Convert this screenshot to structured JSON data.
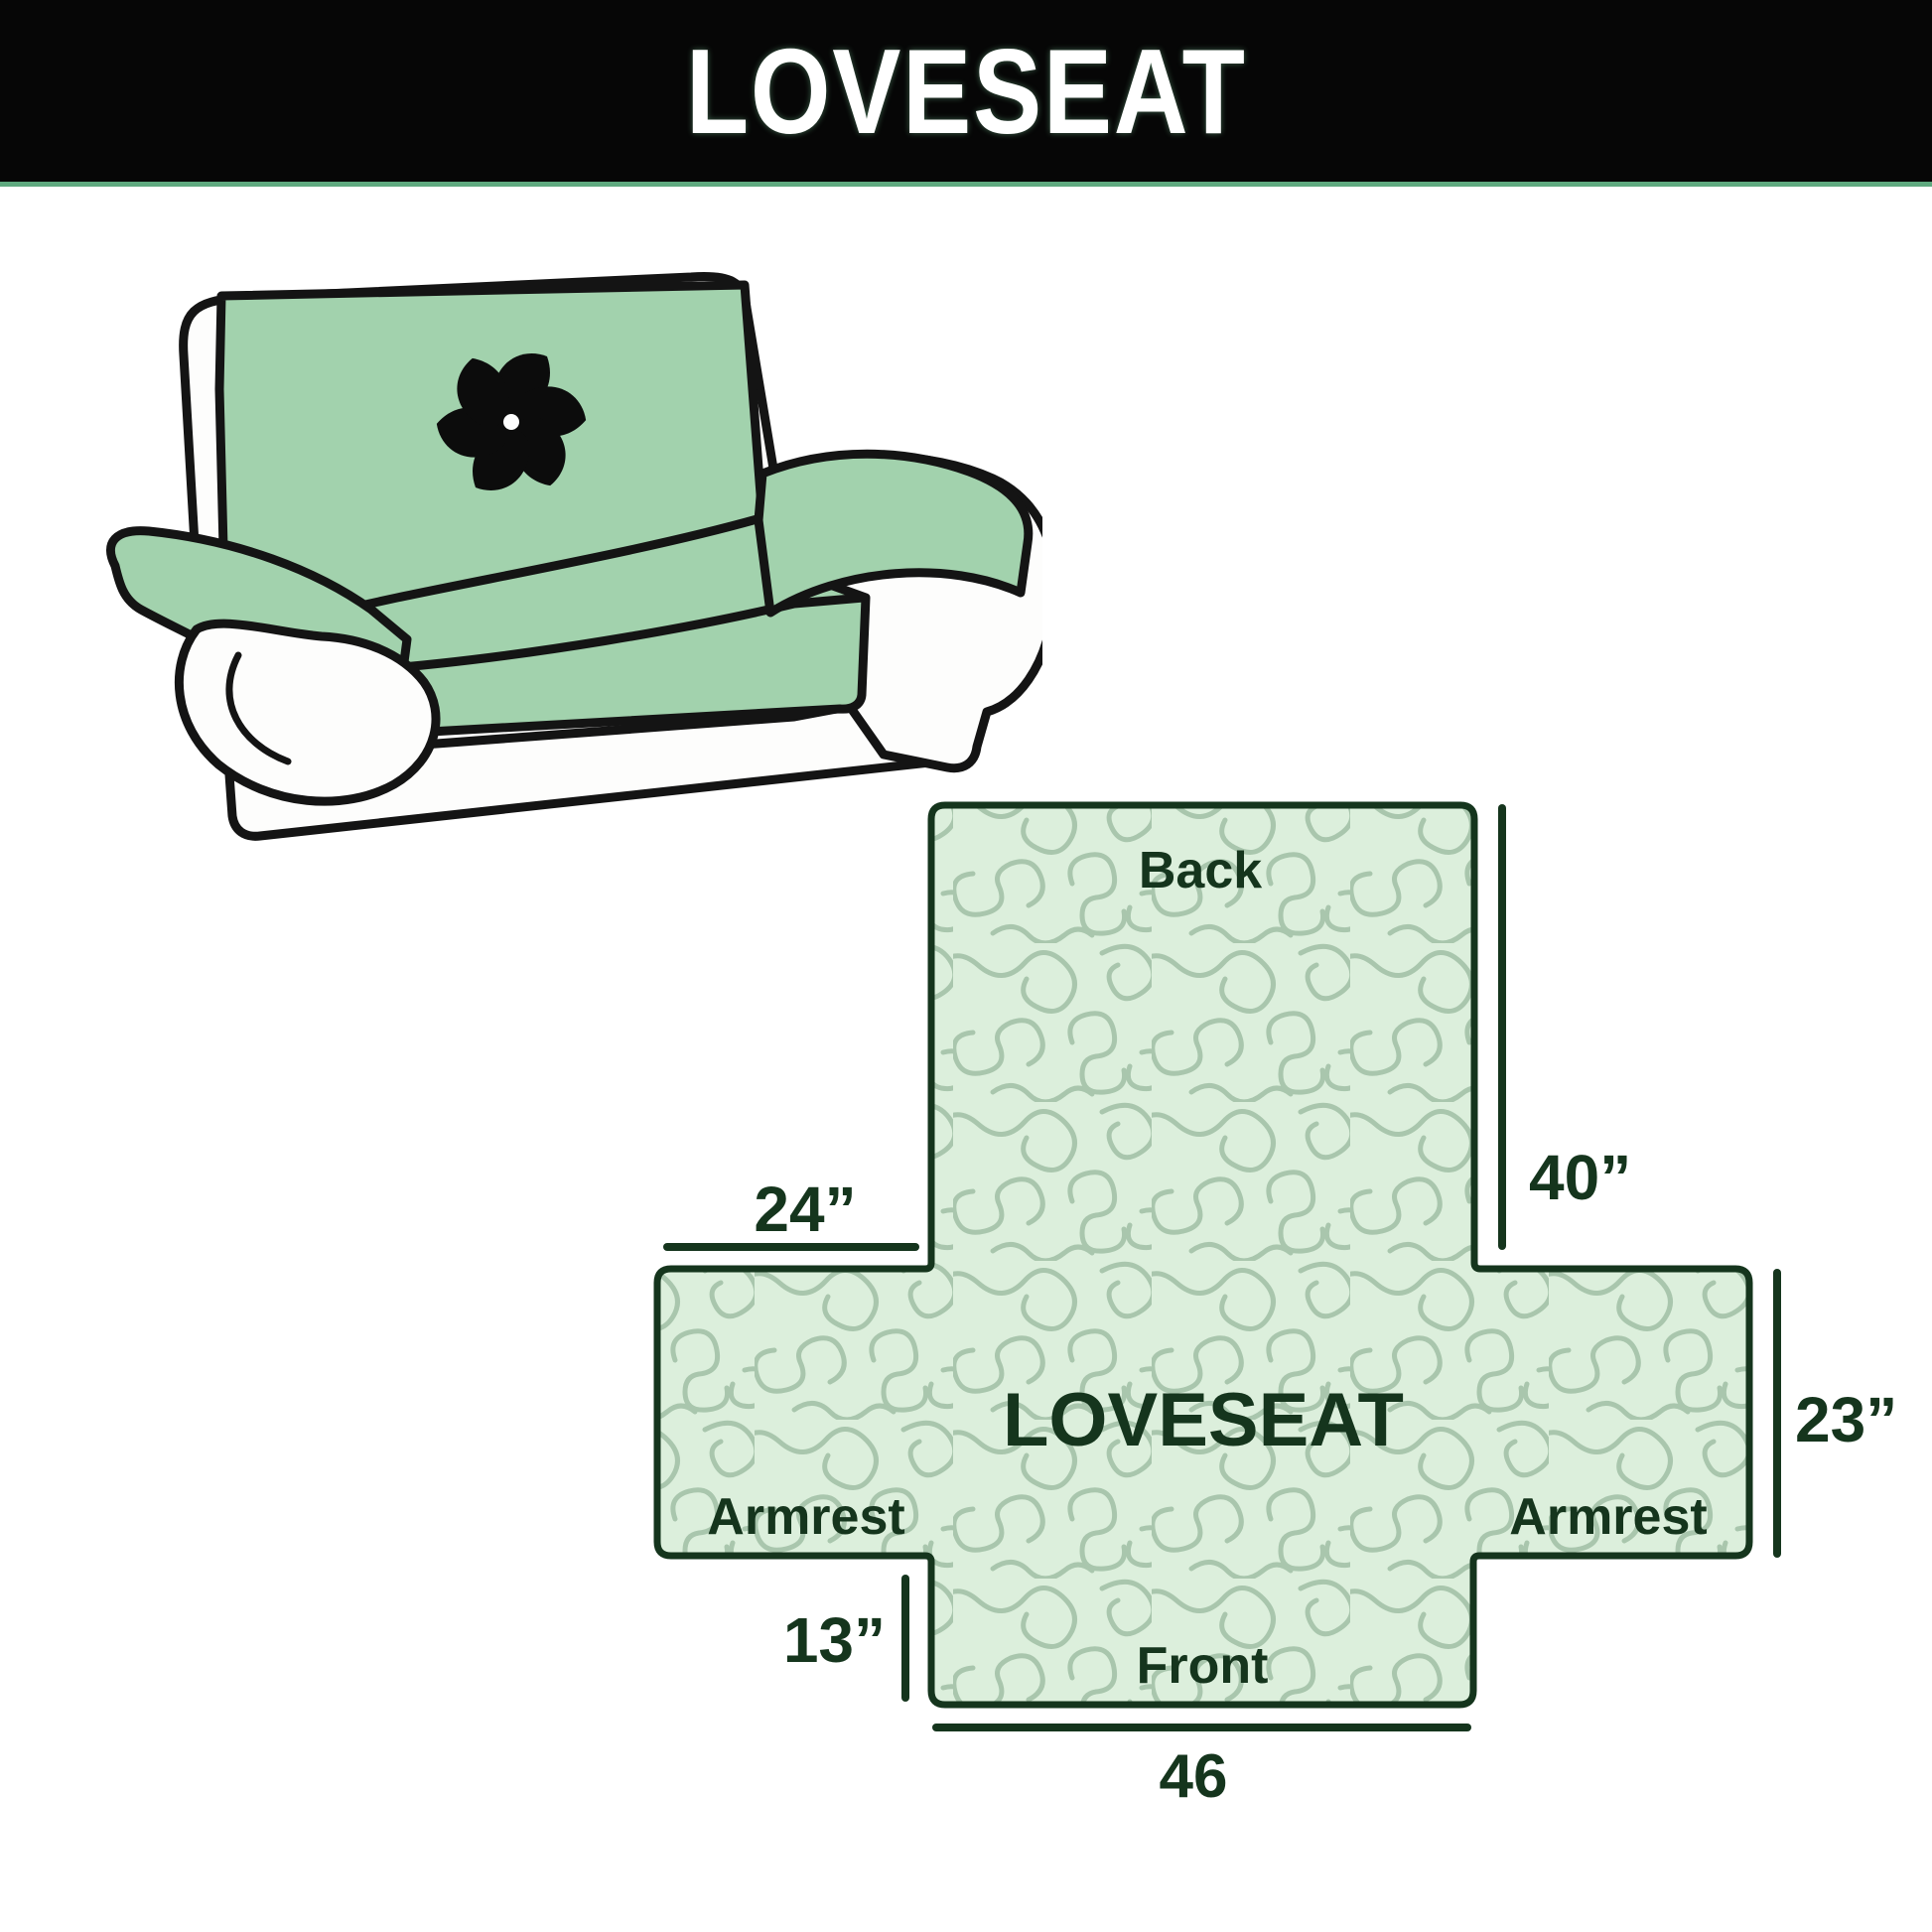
{
  "header": {
    "title": "LOVESEAT"
  },
  "illustration": {
    "description": "loveseat sofa with quilted protective cover",
    "logo_icon": "pinwheel-icon",
    "cover_color": "#a2d2ad",
    "outline_color": "#141414"
  },
  "diagram": {
    "back_label": "Back",
    "center_label": "LOVESEAT",
    "armrest_left_label": "Armrest",
    "armrest_right_label": "Armrest",
    "front_label": "Front",
    "dimensions": {
      "back_height": "40”",
      "top_left_width": "24”",
      "armrest_side_height": "23”",
      "front_flap_height": "13”",
      "bottom_width": "46"
    },
    "colors": {
      "fill": "#dcefdc",
      "pattern_line": "#a9c6ad",
      "border_and_text": "#15351d",
      "header_bg": "#060606",
      "header_accent": "#5fa97f"
    }
  }
}
